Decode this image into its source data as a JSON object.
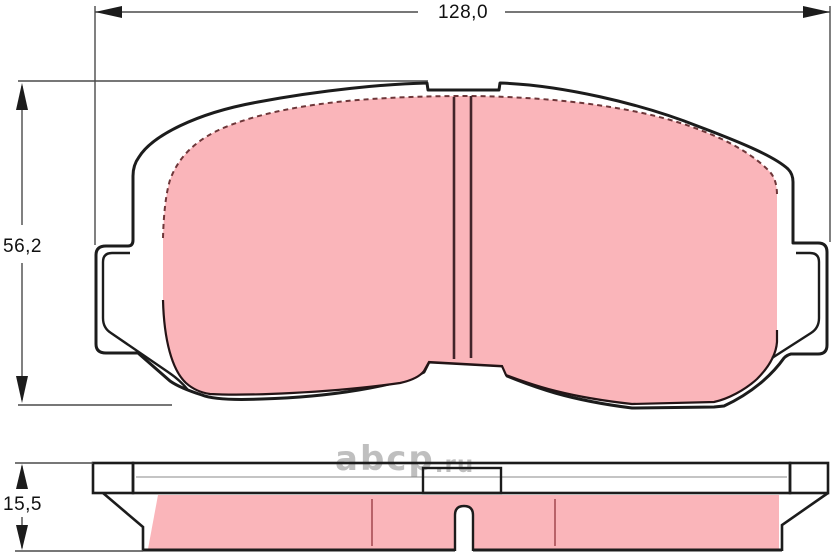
{
  "drawing": {
    "title": "brake pad technical drawing - front view and edge view",
    "dimensions": {
      "width": {
        "label": "128,0"
      },
      "height": {
        "label": "56,2"
      },
      "thickness": {
        "label": "15,5"
      }
    },
    "watermark": {
      "main": "abcp",
      "suffix": ".ru"
    },
    "colors": {
      "pad_fill": "#FAB5BA",
      "outline": "#1C1C1C",
      "dimension_line": "#4A4A4A",
      "groove": "#43242A",
      "friction_dash": "#6E3639",
      "segment_line": "#A84E55",
      "watermark": "#B0B0B0",
      "label_text": "#111111"
    }
  }
}
